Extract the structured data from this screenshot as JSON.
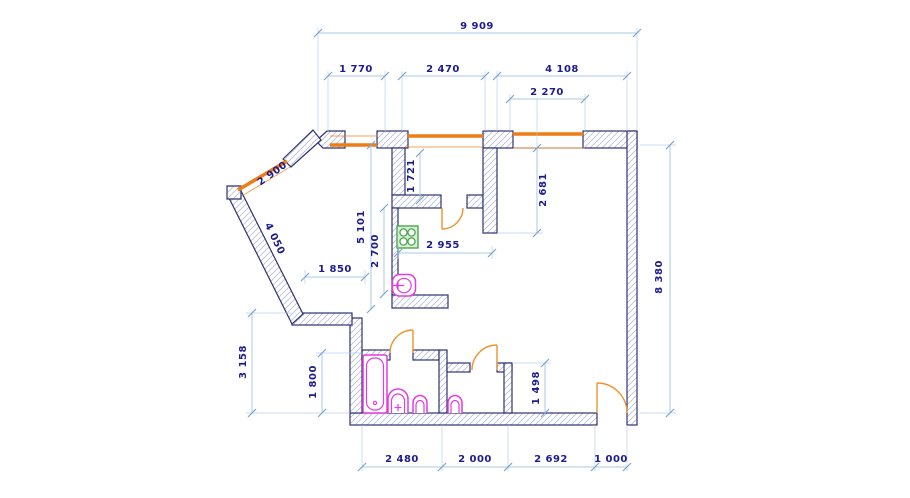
{
  "colors": {
    "background": "#ffffff",
    "wall_outline": "#2f3270",
    "wall_hatch": "#b6bfd8",
    "dimension_line": "#aac9e6",
    "dimension_text": "#1c1c8f",
    "window": "#ed7d14",
    "door": "#e9952e",
    "plumbing_fixture": "#e23ce2",
    "stove": "#4ca64c"
  },
  "dims": {
    "overall_top": "9 909",
    "top_seg_left": "1 770",
    "top_seg_mid": "2 470",
    "top_seg_right": "4 108",
    "top_window_right": "2 270",
    "balcony_depth": "1 721",
    "living_nook_depth": "2 681",
    "diagonal_window": "2 900",
    "diagonal_wall": "4 050",
    "hall_depth": "5 101",
    "kitchen_depth": "2 700",
    "kitchen_width": "2 955",
    "hall_width": "1 850",
    "overall_right": "8 380",
    "left_lower_height": "3 158",
    "bathroom_depth": "1 800",
    "lower_nook_depth": "1 498",
    "bottom_seg_1": "2 480",
    "bottom_seg_2": "2 000",
    "bottom_seg_3": "2 692",
    "bottom_seg_4": "1 000"
  },
  "fixtures": {
    "bathtub": "bathtub",
    "washbasin": "washbasin",
    "toilet_bathroom": "toilet",
    "toilet_wc": "toilet",
    "kitchen_sink": "kitchen-sink",
    "stove": "stove-4-burner"
  }
}
